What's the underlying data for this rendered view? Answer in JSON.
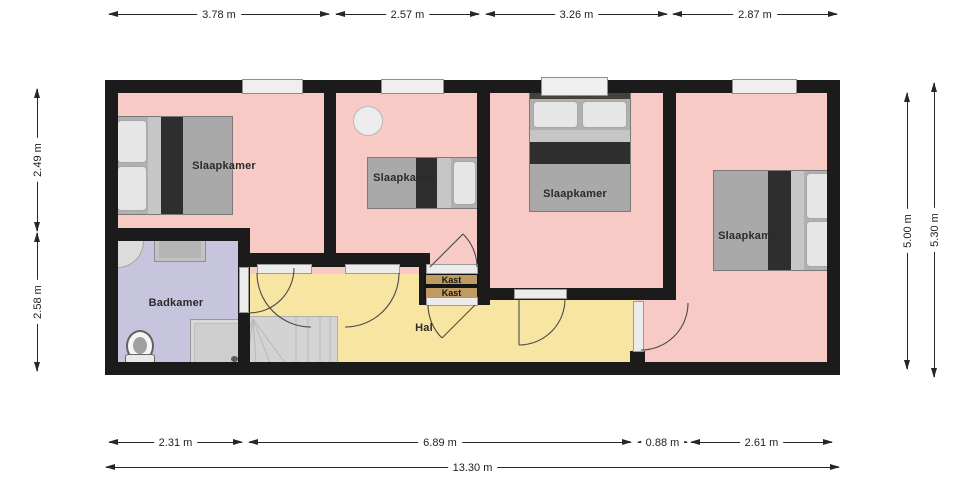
{
  "plan": {
    "type": "floor-plan",
    "rooms": {
      "bedroom_left": {
        "label": "Slaapkamer"
      },
      "bedroom_mid": {
        "label": "Slaapkamer"
      },
      "bedroom_back": {
        "label": "Slaapkamer"
      },
      "bedroom_right": {
        "label": "Slaapkamer"
      },
      "bathroom": {
        "label": "Badkamer"
      },
      "hall": {
        "label": "Hal"
      },
      "closet_top": {
        "label": "Kast"
      },
      "closet_bottom": {
        "label": "Kast"
      }
    },
    "dimensions": {
      "top": [
        "3.78 m",
        "2.57 m",
        "3.26 m",
        "2.87 m"
      ],
      "left": [
        "2.49 m",
        "2.58 m"
      ],
      "right": [
        "5.00 m",
        "5.30 m"
      ],
      "bottom": [
        "2.31 m",
        "6.89 m",
        "0.88 m",
        "2.61 m"
      ],
      "total_width": "13.30 m"
    },
    "colors": {
      "bedroom_floor": "#f7cac5",
      "bathroom_floor": "#c6c5dd",
      "hall_floor": "#f8e5a1",
      "closet": "#bf9a62",
      "wall": "#1b1b1b",
      "window": "#efefef",
      "stairs": "#d3d3d3"
    }
  }
}
